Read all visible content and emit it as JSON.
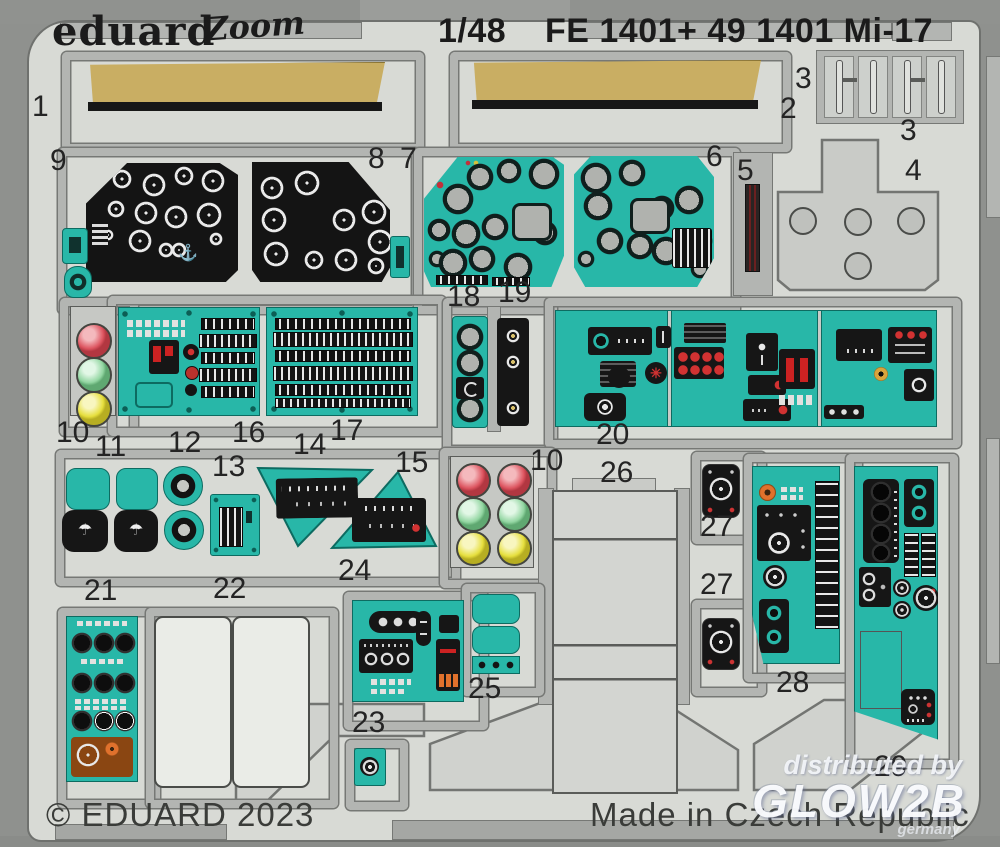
{
  "header": {
    "brand": "eduard",
    "brand_script": "Zoom",
    "scale": "1/48",
    "product_code": "FE 1401+ 49 1401 Mi-17"
  },
  "footer": {
    "copyright": "© EDUARD 2023",
    "origin": "Made in Czech Republic"
  },
  "watermark": {
    "line1": "distributed by",
    "line2": "GLOW2B",
    "line3": "germany"
  },
  "icons": {
    "parachute": "☂",
    "anchor": "⚓",
    "fan": "✳"
  },
  "colors": {
    "teal_paint": "#28b7a8",
    "tan_paint": "#c9ae63",
    "black_panel": "#161616",
    "sheet_gray": "#d8dad5",
    "carrier_gray": "#b3b5b2",
    "red_lamp": "#dd5560",
    "green_lamp": "#93d6a2",
    "yellow_lamp": "#e6df3e",
    "red_button": "#cf2a2a",
    "orange_knob": "#e0712c"
  },
  "part_labels": [
    {
      "n": "1",
      "x": 32,
      "y": 92
    },
    {
      "n": "2",
      "x": 780,
      "y": 94
    },
    {
      "n": "3",
      "x": 795,
      "y": 64
    },
    {
      "n": "3",
      "x": 900,
      "y": 116
    },
    {
      "n": "4",
      "x": 905,
      "y": 156
    },
    {
      "n": "9",
      "x": 50,
      "y": 146
    },
    {
      "n": "8",
      "x": 368,
      "y": 144
    },
    {
      "n": "7",
      "x": 400,
      "y": 144
    },
    {
      "n": "6",
      "x": 706,
      "y": 142
    },
    {
      "n": "5",
      "x": 737,
      "y": 156
    },
    {
      "n": "18",
      "x": 447,
      "y": 282
    },
    {
      "n": "19",
      "x": 498,
      "y": 278
    },
    {
      "n": "10",
      "x": 56,
      "y": 418
    },
    {
      "n": "11",
      "x": 95,
      "y": 432
    },
    {
      "n": "12",
      "x": 168,
      "y": 428
    },
    {
      "n": "16",
      "x": 232,
      "y": 418
    },
    {
      "n": "13",
      "x": 212,
      "y": 452
    },
    {
      "n": "14",
      "x": 293,
      "y": 430
    },
    {
      "n": "17",
      "x": 330,
      "y": 416
    },
    {
      "n": "15",
      "x": 395,
      "y": 448
    },
    {
      "n": "20",
      "x": 596,
      "y": 420
    },
    {
      "n": "10",
      "x": 530,
      "y": 446
    },
    {
      "n": "26",
      "x": 600,
      "y": 458
    },
    {
      "n": "27",
      "x": 700,
      "y": 512
    },
    {
      "n": "27",
      "x": 700,
      "y": 570
    },
    {
      "n": "21",
      "x": 84,
      "y": 576
    },
    {
      "n": "22",
      "x": 213,
      "y": 574
    },
    {
      "n": "24",
      "x": 338,
      "y": 556
    },
    {
      "n": "25",
      "x": 468,
      "y": 674
    },
    {
      "n": "23",
      "x": 352,
      "y": 708
    },
    {
      "n": "28",
      "x": 776,
      "y": 668
    },
    {
      "n": "29",
      "x": 874,
      "y": 752
    }
  ]
}
